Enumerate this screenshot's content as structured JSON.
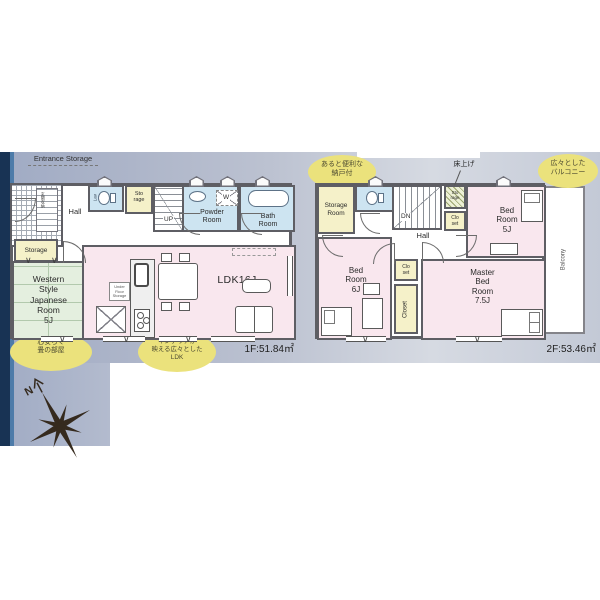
{
  "colors": {
    "band_left": "#a0abc4",
    "band_right": "#d6dae2",
    "navy_bar": "#183354",
    "accent_stripe": "#4d7ba9",
    "wall": "#5e5e64",
    "room_pink": "#f9e7ee",
    "room_blue": "#cde4f1",
    "room_yellow": "#f5f1c9",
    "room_green": "#e4efdf",
    "callout_yellow": "#ebe27c"
  },
  "compass": {
    "north": "N"
  },
  "f1": {
    "area": "1F:51.84㎡",
    "entrance": "Entrance Storage",
    "genkan": "玄関収納",
    "hall": "Hall",
    "lav": "Lav",
    "sto1": "Sto",
    "sto2": "rage",
    "up": "UP",
    "powder1": "Powder",
    "powder2": "Room",
    "w": "W",
    "bath1": "Bath",
    "bath2": "Room",
    "storage": "Storage",
    "jp1": "Western",
    "jp2": "Style",
    "jp3": "Japanese",
    "jp4": "Room",
    "jp5": "5J",
    "ldk": "LDK16J",
    "ufs1": "Under",
    "ufs2": "Floor",
    "ufs3": "Storage",
    "co_tatami1": "心安らぐ",
    "co_tatami2": "畳の部屋",
    "co_ldk1": "インテリアが",
    "co_ldk2": "映える広々とした",
    "co_ldk3": "LDK"
  },
  "f2": {
    "area": "2F:53.46㎡",
    "co_nando1": "あると便利な",
    "co_nando2": "納戸付",
    "co_bal1": "広々とした",
    "co_bal2": "バルコニー",
    "agari": "床上げ",
    "stroom1": "Storage",
    "stroom2": "Room",
    "dn": "DN",
    "sto1": "Sto",
    "sto2": "rage",
    "cloA1": "Clo",
    "cloA2": "set",
    "bed5_1": "Bed",
    "bed5_2": "Room",
    "bed5_3": "5J",
    "hall": "Hall",
    "cloB1": "Clo",
    "cloB2": "set",
    "closet": "Closet",
    "bed6_1": "Bed",
    "bed6_2": "Room",
    "bed6_3": "6J",
    "m1": "Master",
    "m2": "Bed",
    "m3": "Room",
    "m4": "7.5J",
    "balcony": "Balcony"
  }
}
